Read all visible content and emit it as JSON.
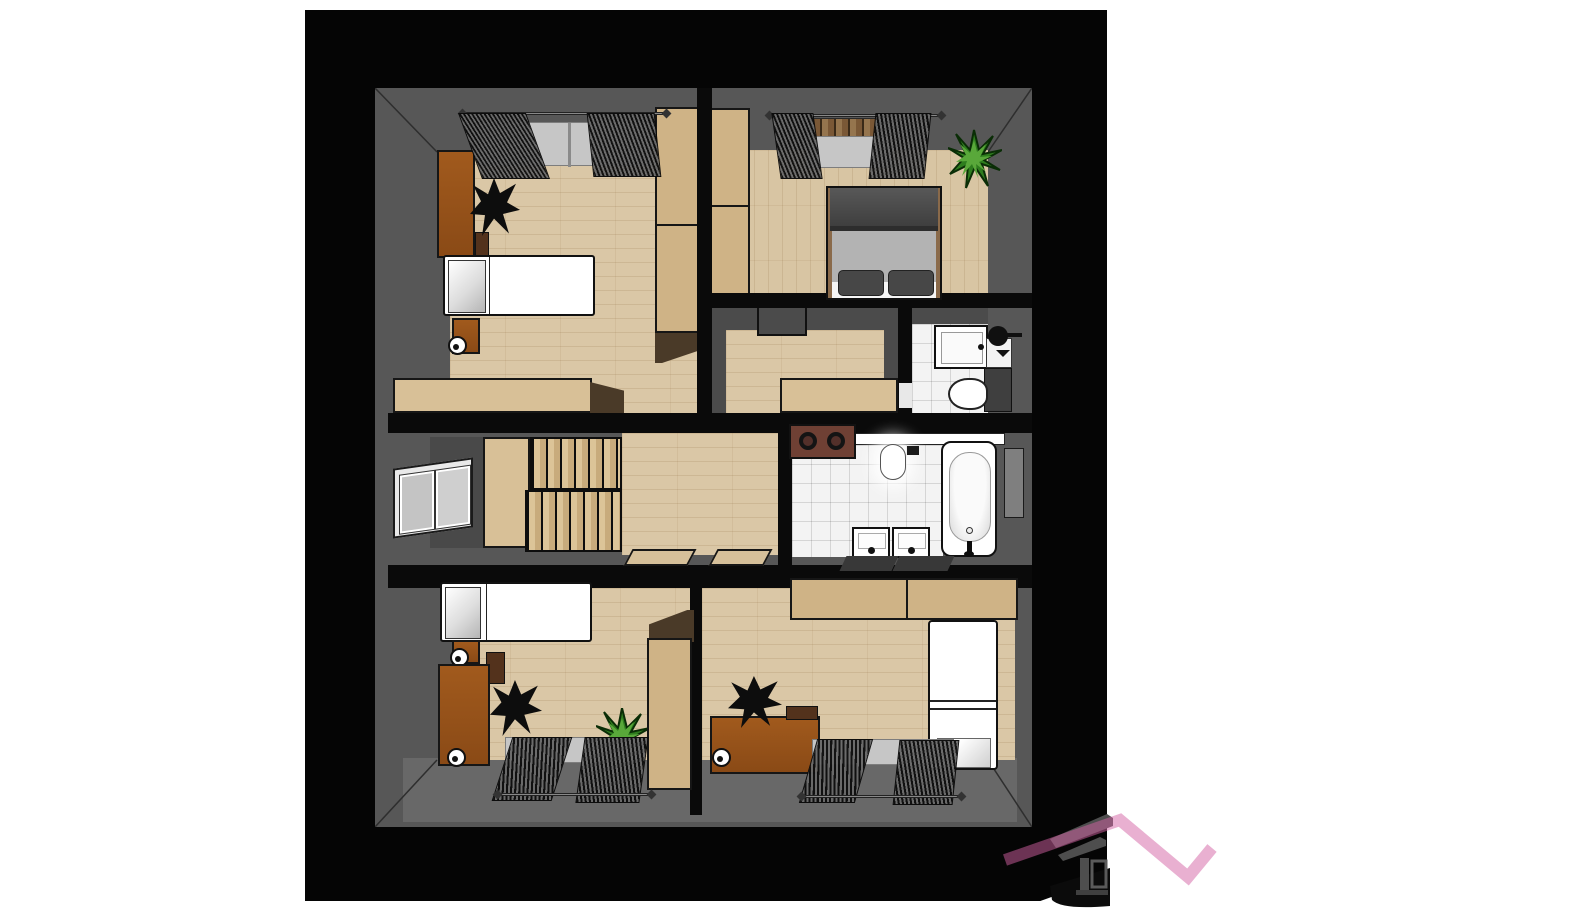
{
  "scene": {
    "kind": "3d-floor-plan-render",
    "view": "top-down dollhouse cutaway of an upper floor",
    "background": "#ffffff",
    "visible_text": ""
  },
  "palette": {
    "frame_black": "#050505",
    "wall_gray": "#575757",
    "inner_wall_gray": "#4b4b4b",
    "floor_wood": "#dac7a6",
    "tile_white": "#f3f3f3",
    "cabinet_tan": "#cfb386",
    "counter_beige": "#d8c097",
    "desk_brown": "#9a5a1e",
    "dark_wood": "#4a3a28",
    "plant_green": "#2e7d1e",
    "logo_pink": "#d263a3",
    "logo_gray": "#4e4e4e"
  },
  "rooms": [
    {
      "id": "bedroom-top-left",
      "furniture": [
        "desk",
        "office-chair",
        "drawer-unit",
        "single-bed",
        "nightstand",
        "table-lamp",
        "tall-wardrobe",
        "sideboard",
        "window-with-curtains"
      ]
    },
    {
      "id": "bedroom-top-right",
      "furniture": [
        "tall-wardrobe",
        "double-bed",
        "pillows",
        "potted-plant",
        "window-with-curtains",
        "wood-slat-transom"
      ]
    },
    {
      "id": "walk-in-closet",
      "furniture": [
        "wall-notch",
        "beige-counter"
      ]
    },
    {
      "id": "wc",
      "furniture": [
        "shower-cabin",
        "toilet",
        "cistern-block",
        "wall-cabinet",
        "round-wall-basin",
        "door-leaf"
      ]
    },
    {
      "id": "stair-hall",
      "furniture": [
        "staircase",
        "stair-landing",
        "side-window",
        "hall-floor",
        "two-door-mats"
      ]
    },
    {
      "id": "bathroom",
      "furniture": [
        "laundry-box-two-openings",
        "wall-ledge",
        "toilet-glowing",
        "bathtub-with-faucet",
        "tall-side-cabinet",
        "two-washbasins",
        "two-dark-bath-mats"
      ]
    },
    {
      "id": "bedroom-bottom-left",
      "furniture": [
        "single-bed",
        "nightstand",
        "table-lamp",
        "desk",
        "shelf",
        "office-chair",
        "potted-plant",
        "tall-wardrobe",
        "window-with-curtains"
      ]
    },
    {
      "id": "bedroom-bottom-right",
      "furniture": [
        "wall-cabinets",
        "fridge-style-tall-cabinet",
        "desk",
        "office-chair",
        "desk-caddy",
        "window-with-curtains"
      ]
    }
  ],
  "logo": {
    "name": "house-roofline-logo",
    "elements": [
      "gray-roof-bars",
      "gray-pillar",
      "window-outline",
      "pink-zigzag-roofline"
    ],
    "zigzag_color": "#d263a3",
    "house_color": "#4e4e4e"
  }
}
